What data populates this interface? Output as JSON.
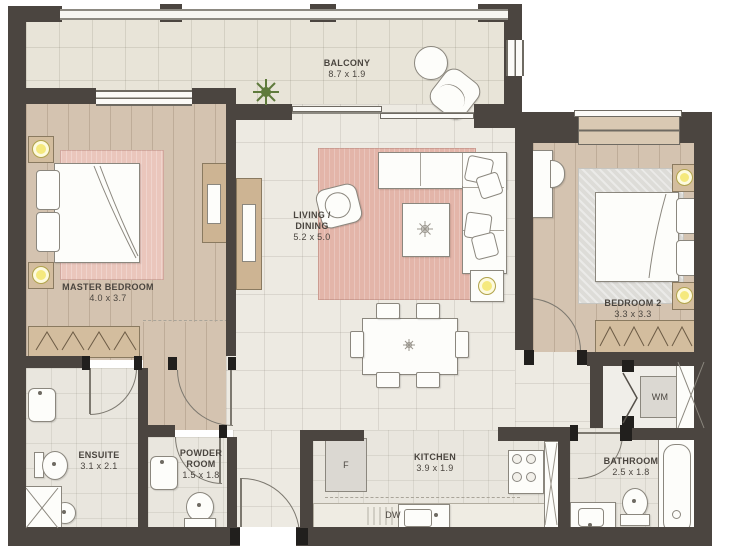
{
  "plan": {
    "type": "apartment-floor-plan",
    "rooms": {
      "balcony": {
        "name": "BALCONY",
        "dims": "8.7 x 1.9"
      },
      "master_bedroom": {
        "name": "MASTER BEDROOM",
        "dims": "4.0 x 3.7"
      },
      "living_dining": {
        "name1": "LIVING /",
        "name2": "DINING",
        "dims": "5.2 x 5.0"
      },
      "bedroom_2": {
        "name": "BEDROOM 2",
        "dims": "3.3 x 3.3"
      },
      "ensuite": {
        "name": "ENSUITE",
        "dims": "3.1 x 2.1"
      },
      "powder_room": {
        "name1": "POWDER",
        "name2": "ROOM",
        "dims": "1.5 x 1.8"
      },
      "kitchen": {
        "name": "KITCHEN",
        "dims": "3.9 x 1.9"
      },
      "bathroom": {
        "name": "BATHROOM",
        "dims": "2.5 x 1.8"
      }
    },
    "appliances": {
      "fridge": "F",
      "dishwasher": "DW",
      "washing_machine": "WM"
    },
    "colors": {
      "wall": "#4b4540",
      "wood_floor": "#d4c3b0",
      "tile_floor": "#edeae2",
      "balcony_tile": "#e8e4d8",
      "rug_pink": "#e3b5a9",
      "rug_gray": "#dcdcd8",
      "lamp_accent": "#f5e97d",
      "plant_green": "#5f7a3c"
    }
  }
}
